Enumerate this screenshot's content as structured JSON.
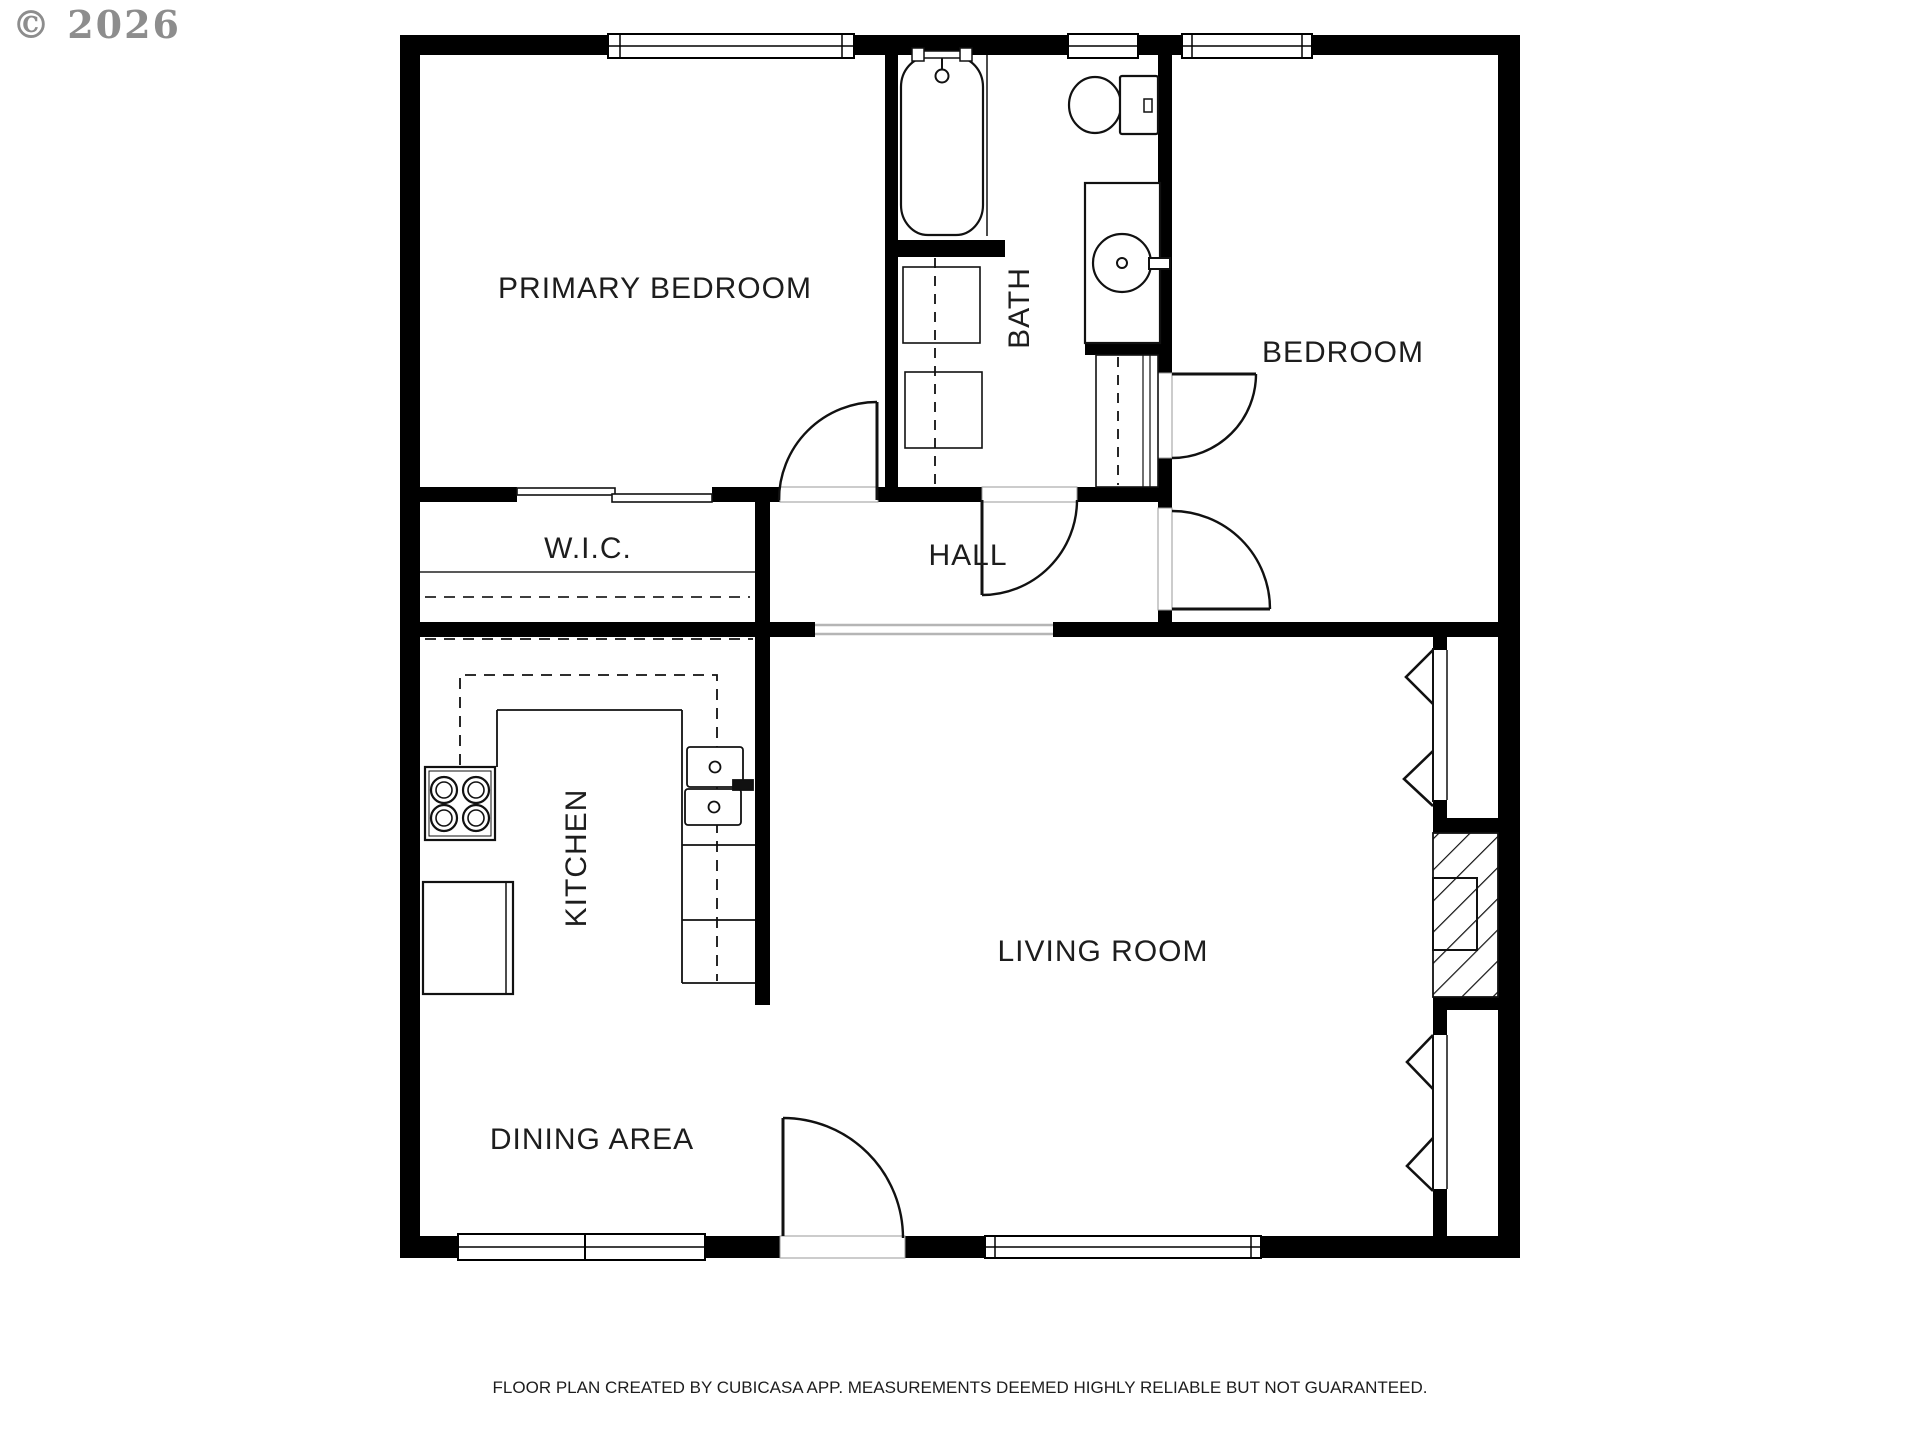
{
  "watermark": {
    "text": "© 2026"
  },
  "footer": {
    "text": "FLOOR PLAN CREATED BY CUBICASA APP. MEASUREMENTS DEEMED HIGHLY RELIABLE BUT NOT GUARANTEED."
  },
  "rooms": {
    "primary_bedroom": "PRIMARY BEDROOM",
    "bath": "BATH",
    "bedroom": "BEDROOM",
    "wic": "W.I.C.",
    "hall": "HALL",
    "kitchen": "KITCHEN",
    "living_room": "LIVING ROOM",
    "dining_area": "DINING AREA"
  },
  "fixtures": {
    "bath": [
      "bathtub",
      "tub-faucet",
      "toilet",
      "vanity-sink",
      "linen-cabinets",
      "closet"
    ],
    "kitchen": [
      "stove-4-burners",
      "refrigerator",
      "double-sink",
      "counters",
      "upper-cabinets-dashed"
    ],
    "living_room": [
      "fireplace-hatched",
      "casement-window-chevrons"
    ],
    "doors": [
      "primary-bedroom-door",
      "bath-door",
      "bedroom-closet-door",
      "bedroom-door",
      "entry-door",
      "wic-bypass-door"
    ],
    "windows": [
      "primary-bedroom-window",
      "bath-window",
      "bedroom-window",
      "dining-window-left",
      "dining-window-right",
      "living-room-window"
    ]
  },
  "colors": {
    "wall": "#000000",
    "line": "#1a1a1a",
    "threshold": "#b5b5b5",
    "watermark": "#8d8d8d",
    "background": "#ffffff"
  }
}
